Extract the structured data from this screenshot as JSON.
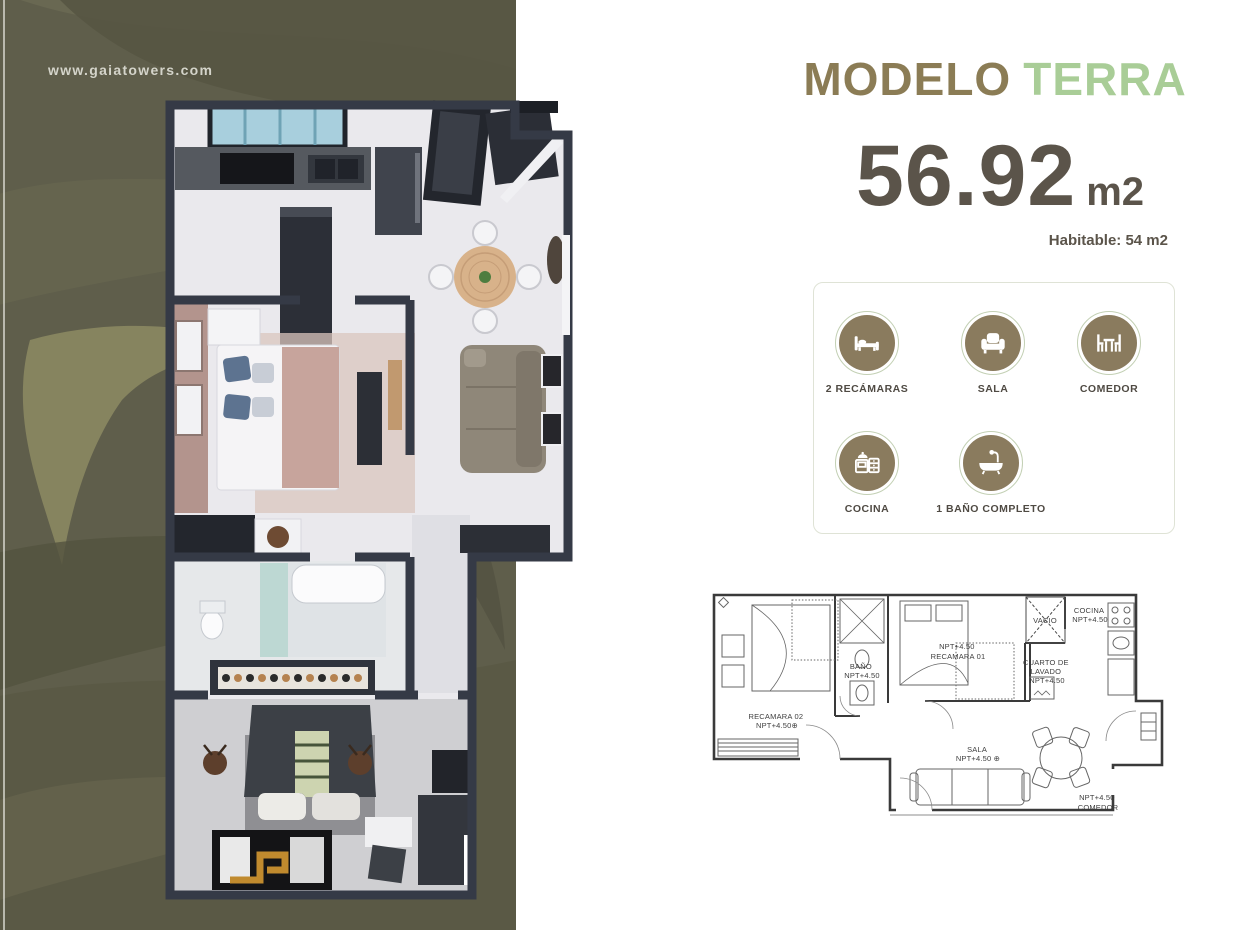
{
  "website": "www.gaiatowers.com",
  "header": {
    "title_primary": "MODELO",
    "title_accent": "TERRA"
  },
  "area": {
    "value": "56.92",
    "unit": "m2",
    "habitable": "Habitable: 54 m2"
  },
  "features": [
    {
      "icon": "bed-icon",
      "label": "2 RECÁMARAS"
    },
    {
      "icon": "armchair-icon",
      "label": "SALA"
    },
    {
      "icon": "dining-table-icon",
      "label": "COMEDOR"
    },
    {
      "icon": "stove-icon",
      "label": "COCINA"
    },
    {
      "icon": "bathtub-icon",
      "label": "1 BAÑO COMPLETO"
    }
  ],
  "plan2d": {
    "recamara02": [
      "RECAMARA 02",
      "NPT+4.50⊕"
    ],
    "bano": [
      "BAÑO",
      "NPT+4.50"
    ],
    "recamara01": [
      "NPT+4.50",
      "RECAMARA 01"
    ],
    "vacio": [
      "VACIO"
    ],
    "cocina": [
      "COCINA",
      "NPT+4.50"
    ],
    "cuarto_lavado": [
      "CUARTO DE",
      "LAVADO",
      "NPT+4.50"
    ],
    "sala": [
      "SALA",
      "NPT+4.50 ⊕"
    ],
    "comedor": [
      "NPT+4.50",
      "COMEDOR"
    ]
  },
  "colors": {
    "panel_olive": "#5f5e4b",
    "brand_brown": "#8b7c55",
    "accent_green": "#a9cd97",
    "number_gray": "#5b544a",
    "icon_tan": "#8a7b5e",
    "icon_ring_sage": "#c3d0b4",
    "plan_line_gray": "#3f3f3f"
  }
}
